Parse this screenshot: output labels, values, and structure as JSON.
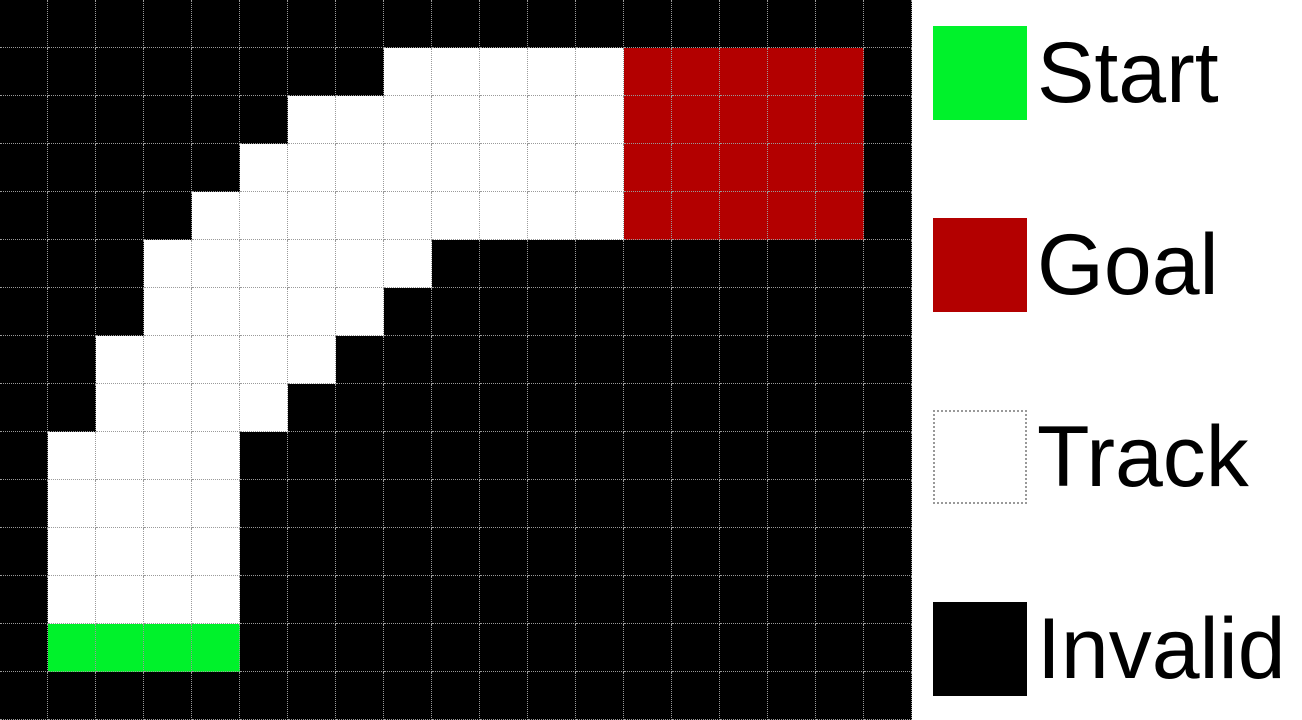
{
  "legend": {
    "items": [
      {
        "id": "start",
        "label": "Start",
        "color": "#00F22B",
        "border": "none",
        "top": 26
      },
      {
        "id": "goal",
        "label": "Goal",
        "color": "#B30000",
        "border": "none",
        "top": 218
      },
      {
        "id": "track",
        "label": "Track",
        "color": "#FFFFFF",
        "border": "2px dotted #999999",
        "top": 410
      },
      {
        "id": "invalid",
        "label": "Invalid",
        "color": "#000000",
        "border": "none",
        "top": 602
      }
    ]
  },
  "grid": {
    "type": "heatmap",
    "rows": 15,
    "cols": 19,
    "cell_size_px": 48,
    "gridline_style": "1px dotted #9a9a9a",
    "cell_types": {
      ".": "invalid",
      "T": "track",
      "S": "start",
      "G": "goal"
    },
    "colors": {
      "invalid": "#000000",
      "track": "#FFFFFF",
      "start": "#00F22B",
      "goal": "#B30000"
    },
    "cells": [
      "...................",
      "........TTTTTGGGGG.",
      "......TTTTTTTGGGGG.",
      ".....TTTTTTTTGGGGG.",
      "....TTTTTTTTTGGGGG.",
      "...TTTTTT..........",
      "...TTTTT...........",
      "..TTTTT............",
      "..TTTT.............",
      ".TTTT..............",
      ".TTTT..............",
      ".TTTT..............",
      ".TTTT..............",
      ".SSSS..............",
      "..................."
    ]
  }
}
